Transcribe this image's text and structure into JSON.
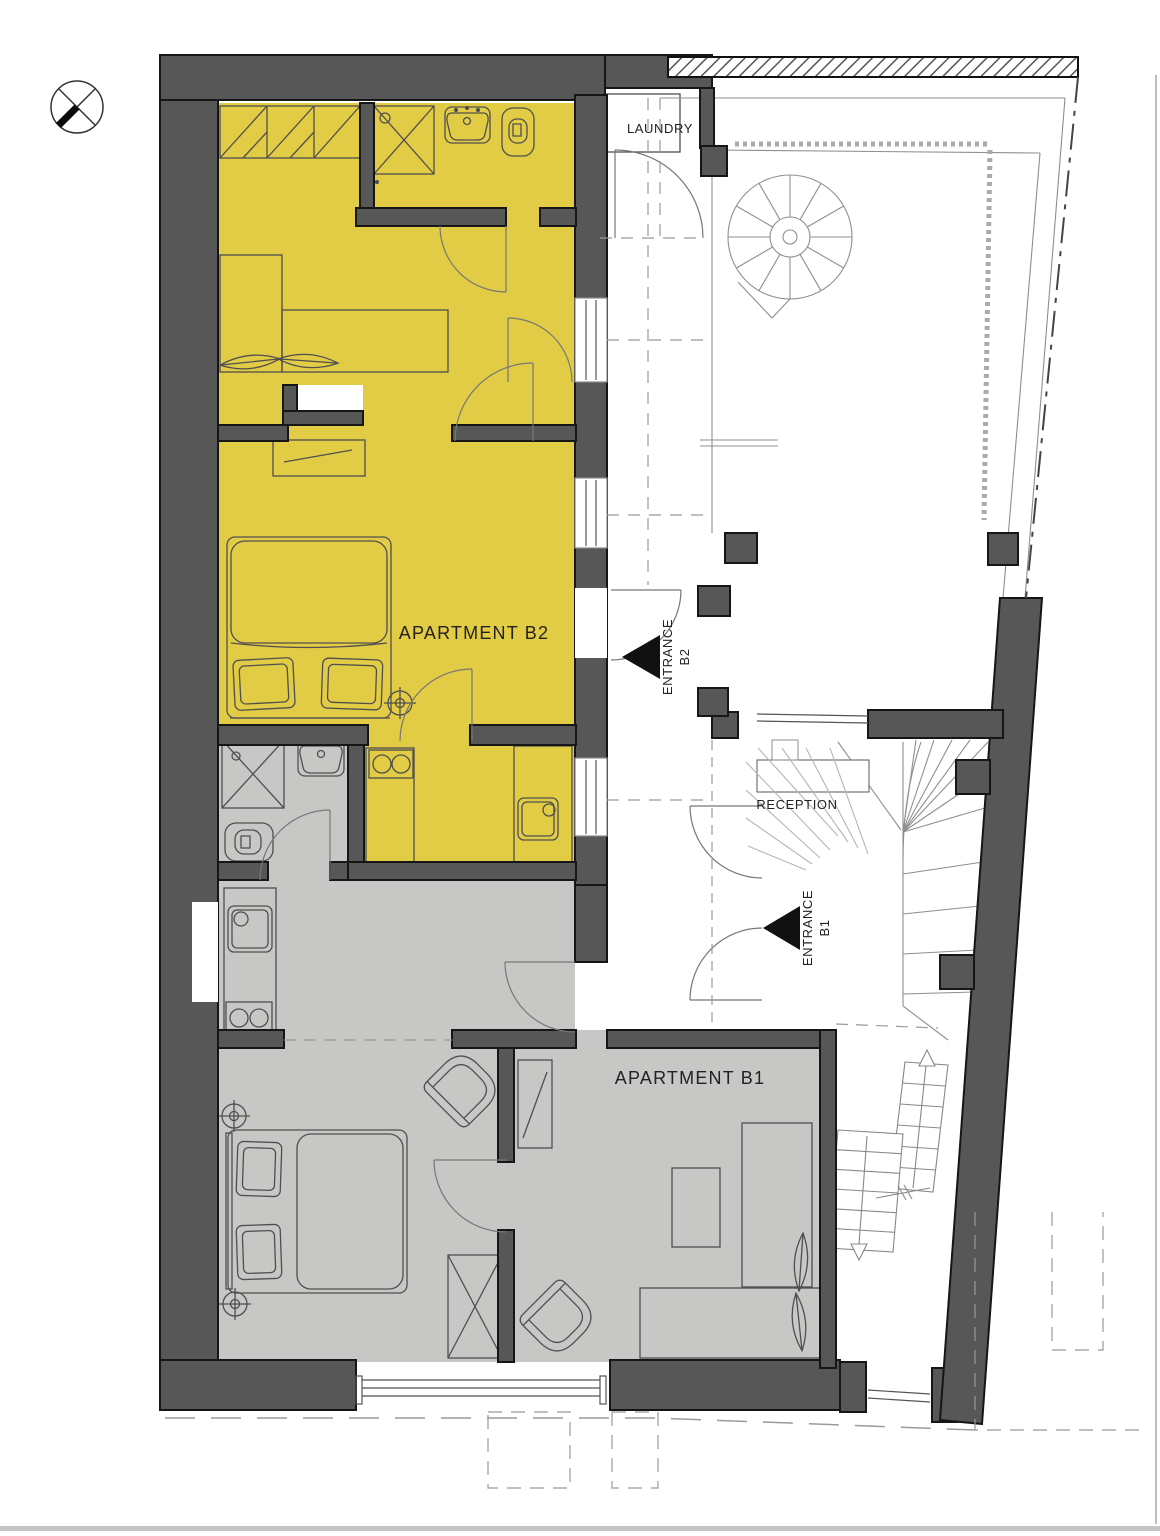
{
  "document": {
    "type": "architectural floor plan",
    "description": "Ground floor plan with two apartments, reception, laundry and courtyard with spiral stair"
  },
  "labels": {
    "laundry": "LAUNDRY",
    "reception": "RECEPTION",
    "apartment_b2": "APARTMENT B2",
    "apartment_b1": "APARTMENT B1",
    "entrance_b2": {
      "line1": "ENTRANCE",
      "line2": "B2"
    },
    "entrance_b1": {
      "line1": "ENTRANCE",
      "line2": "B1"
    }
  },
  "colors": {
    "apartment_b2_fill": "#e2cb45",
    "apartment_b1_fill": "#c7c7c5",
    "wall_fill": "#575757",
    "entrance_marker": "#111111",
    "background": "#ffffff"
  },
  "icons": {
    "north_indicator": "north-compass-icon",
    "entrance_b2_marker": "entrance-arrow-icon",
    "entrance_b1_marker": "entrance-arrow-icon",
    "spiral_stair": "spiral-staircase-symbol",
    "straight_stair": "staircase-symbol"
  }
}
